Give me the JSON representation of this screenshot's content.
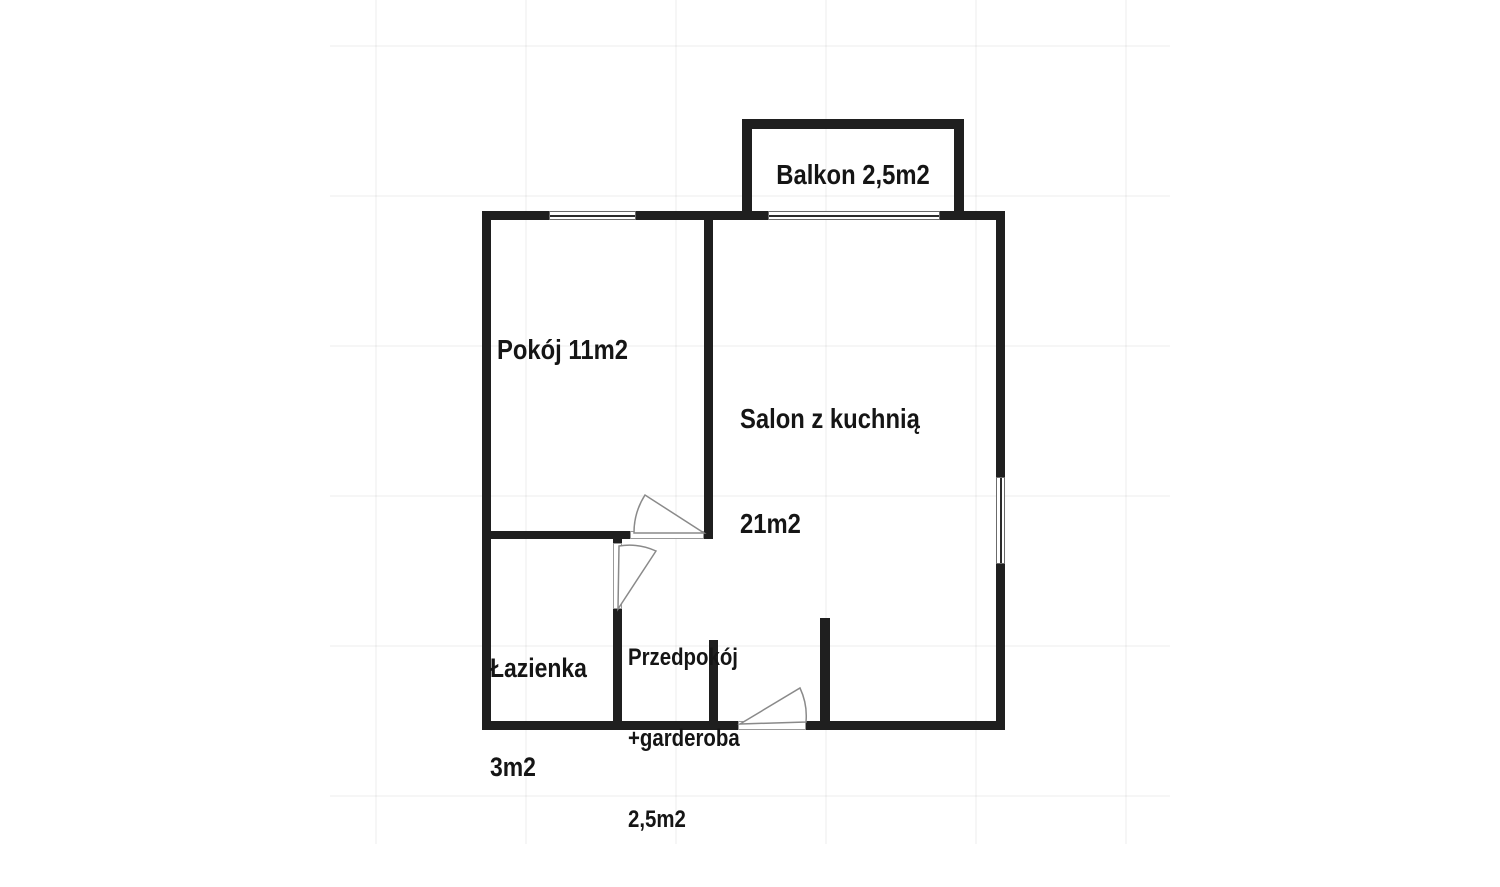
{
  "plan": {
    "type": "apartment-floor-plan",
    "rooms": {
      "balkon": {
        "label": "Balkon 2,5m2"
      },
      "pokoj": {
        "label": "Pokój 11m2"
      },
      "salon": {
        "line1": "Salon z kuchnią",
        "line2": "21m2"
      },
      "lazienka": {
        "line1": "Łazienka",
        "line2": "3m2"
      },
      "przedpokoj": {
        "line1": "Przedpokój",
        "line2": "+garderoba",
        "line3": "2,5m2"
      }
    },
    "colors": {
      "wall": "#1f1f1f",
      "door_arc": "#8a8a8a",
      "window_frame": "#6b6b6b",
      "text": "#151515",
      "background": "#ffffff"
    }
  }
}
